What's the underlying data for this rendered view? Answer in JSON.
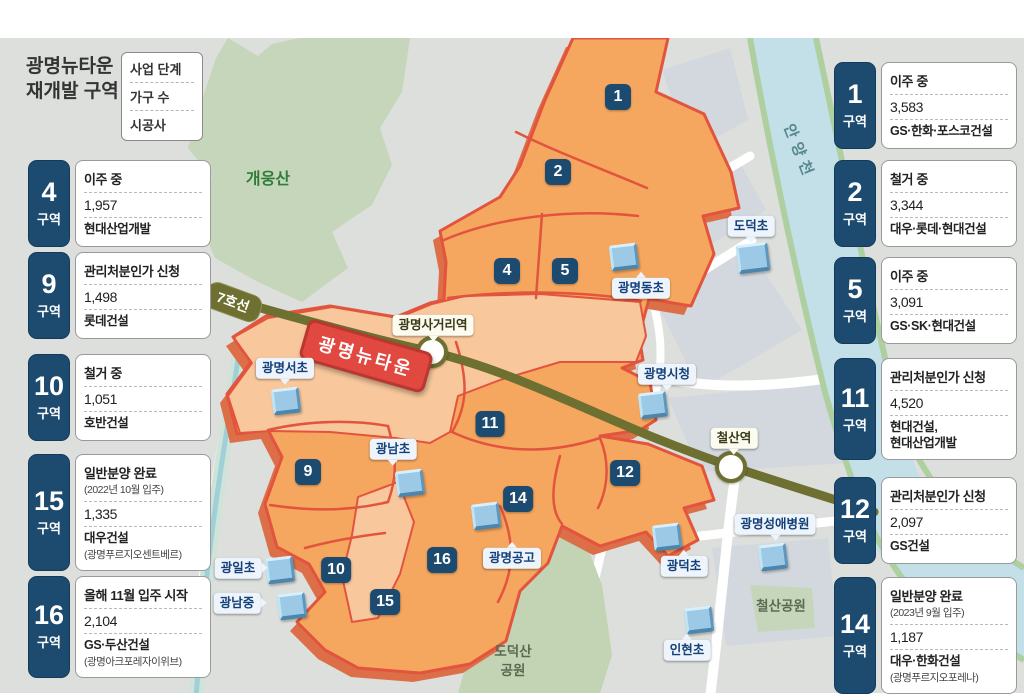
{
  "title": {
    "line1": "광명뉴타운",
    "line2": "재개발 구역"
  },
  "legend": {
    "row1": "사업 단계",
    "row2": "가구 수",
    "row3": "시공사"
  },
  "unit_label": "구역",
  "left_boxes": [
    {
      "zone": "4",
      "status": "이주 중",
      "households": "1,957",
      "builder": "현대산업개발"
    },
    {
      "zone": "9",
      "status": "관리처분인가 신청",
      "households": "1,498",
      "builder": "롯데건설"
    },
    {
      "zone": "10",
      "status": "철거 중",
      "households": "1,051",
      "builder": "호반건설"
    },
    {
      "zone": "15",
      "status": "일반분양 완료",
      "status_note": "(2022년 10월 입주)",
      "households": "1,335",
      "builder": "대우건설",
      "builder_note": "(광명푸르지오센트베르)"
    },
    {
      "zone": "16",
      "status": "올해 11월 입주 시작",
      "households": "2,104",
      "builder": "GS·두산건설",
      "builder_note": "(광명아크포레자이위브)"
    }
  ],
  "right_boxes": [
    {
      "zone": "1",
      "status": "이주 중",
      "households": "3,583",
      "builder": "GS·한화·포스코건설"
    },
    {
      "zone": "2",
      "status": "철거 중",
      "households": "3,344",
      "builder": "대우·롯데·현대건설"
    },
    {
      "zone": "5",
      "status": "이주 중",
      "households": "3,091",
      "builder": "GS·SK·현대건설"
    },
    {
      "zone": "11",
      "status": "관리처분인가 신청",
      "households": "4,520",
      "builder": "현대건설,",
      "builder2": "현대산업개발"
    },
    {
      "zone": "12",
      "status": "관리처분인가 신청",
      "households": "2,097",
      "builder": "GS건설"
    },
    {
      "zone": "14",
      "status": "일반분양 완료",
      "status_note": "(2023년 9월 입주)",
      "households": "1,187",
      "builder": "대우·한화건설",
      "builder_note": "(광명푸르지오포레나)"
    }
  ],
  "map": {
    "newtown_badge": "광명뉴타운",
    "line7_label": "7호선",
    "stations": {
      "sageori": "광명사거리역",
      "cheolsan": "철산역"
    },
    "badge_numbers": [
      "1",
      "2",
      "4",
      "5",
      "9",
      "10",
      "11",
      "12",
      "14",
      "15",
      "16"
    ],
    "places": {
      "gwangmyeongseo": "광명서초",
      "gwangnamcho": "광남초",
      "gwangmyeongdong": "광명동초",
      "dodeokcho": "도덕초",
      "cityhall": "광명시청",
      "gwangilcho": "광일초",
      "gwangnamjung": "광남중",
      "gonggo": "광명공고",
      "gwangdeokcho": "광덕초",
      "inhyeoncho": "인현초",
      "hospital": "광명성애병원"
    },
    "geo": {
      "mountain": "개웅산",
      "dodeoksan_line1": "도덕산",
      "dodeoksan_line2": "공원",
      "cheolsan_park": "철산공원",
      "river": "안양천"
    },
    "colors": {
      "zone_fill": "#f6a75f",
      "zone_light": "#f8c89c",
      "zone_border": "#e2543e",
      "zone_shadow": "#dd6f48",
      "badge_navy": "#1d4b70",
      "newtown_red": "#e04840",
      "line7_olive": "#6d7030",
      "river_blue": "#c3e0e8",
      "park_green": "#c5d6ba",
      "map_bg": "#dcdfdb"
    }
  }
}
